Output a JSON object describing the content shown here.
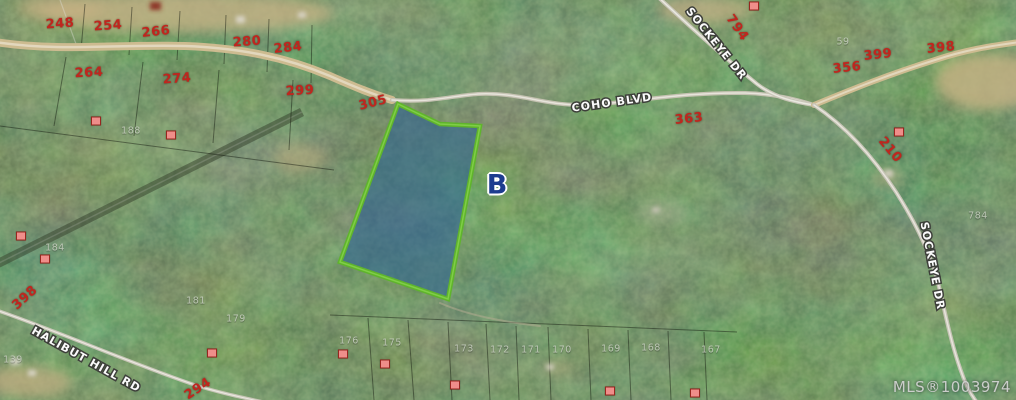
{
  "map": {
    "parcel_label": "B",
    "watermark": "MLS®1003974",
    "road_labels": {
      "coho": "COHO BLVD",
      "sockeye_top": "SOCKEYE DR",
      "sockeye_right": "SOCKEYE DR",
      "halibut": "HALIBUT HILL RD"
    },
    "red_numbers": [
      {
        "text": "248",
        "x": 60,
        "y": 24,
        "rot": -4
      },
      {
        "text": "254",
        "x": 108,
        "y": 26,
        "rot": -4
      },
      {
        "text": "266",
        "x": 156,
        "y": 32,
        "rot": -6
      },
      {
        "text": "280",
        "x": 247,
        "y": 42,
        "rot": -4
      },
      {
        "text": "284",
        "x": 288,
        "y": 48,
        "rot": -6
      },
      {
        "text": "264",
        "x": 89,
        "y": 73,
        "rot": -3
      },
      {
        "text": "274",
        "x": 177,
        "y": 79,
        "rot": -4
      },
      {
        "text": "299",
        "x": 300,
        "y": 91,
        "rot": -3
      },
      {
        "text": "305",
        "x": 373,
        "y": 103,
        "rot": -14
      },
      {
        "text": "363",
        "x": 689,
        "y": 119,
        "rot": -6
      },
      {
        "text": "794",
        "x": 737,
        "y": 28,
        "rot": 55
      },
      {
        "text": "356",
        "x": 847,
        "y": 68,
        "rot": -6
      },
      {
        "text": "399",
        "x": 878,
        "y": 55,
        "rot": -6
      },
      {
        "text": "398",
        "x": 941,
        "y": 48,
        "rot": -6
      },
      {
        "text": "210",
        "x": 890,
        "y": 150,
        "rot": 50
      },
      {
        "text": "398",
        "x": 25,
        "y": 298,
        "rot": -42
      },
      {
        "text": "294",
        "x": 198,
        "y": 389,
        "rot": -33
      }
    ],
    "gray_numbers": [
      {
        "text": "188",
        "x": 131,
        "y": 131
      },
      {
        "text": "184",
        "x": 55,
        "y": 248
      },
      {
        "text": "181",
        "x": 196,
        "y": 301
      },
      {
        "text": "179",
        "x": 236,
        "y": 319
      },
      {
        "text": "139",
        "x": 13,
        "y": 360
      },
      {
        "text": "176",
        "x": 349,
        "y": 341
      },
      {
        "text": "175",
        "x": 392,
        "y": 343
      },
      {
        "text": "173",
        "x": 464,
        "y": 349
      },
      {
        "text": "172",
        "x": 500,
        "y": 350
      },
      {
        "text": "171",
        "x": 531,
        "y": 350
      },
      {
        "text": "170",
        "x": 562,
        "y": 350
      },
      {
        "text": "169",
        "x": 611,
        "y": 349
      },
      {
        "text": "168",
        "x": 651,
        "y": 348
      },
      {
        "text": "167",
        "x": 711,
        "y": 350
      },
      {
        "text": "59",
        "x": 843,
        "y": 42
      },
      {
        "text": "784",
        "x": 978,
        "y": 216
      }
    ],
    "building_markers": [
      {
        "x": 96,
        "y": 121
      },
      {
        "x": 171,
        "y": 135
      },
      {
        "x": 21,
        "y": 236
      },
      {
        "x": 45,
        "y": 259
      },
      {
        "x": 212,
        "y": 353
      },
      {
        "x": 343,
        "y": 354
      },
      {
        "x": 385,
        "y": 364
      },
      {
        "x": 455,
        "y": 385
      },
      {
        "x": 610,
        "y": 391
      },
      {
        "x": 695,
        "y": 393
      },
      {
        "x": 899,
        "y": 132
      },
      {
        "x": 754,
        "y": 6
      }
    ],
    "colors": {
      "parcel_fill": "#2a6096",
      "parcel_outline": "#5fb42c",
      "lot_number_red": "#c0261e",
      "marker_pink": "#ef8e8a",
      "label_b_blue": "#1d3c8f"
    }
  }
}
